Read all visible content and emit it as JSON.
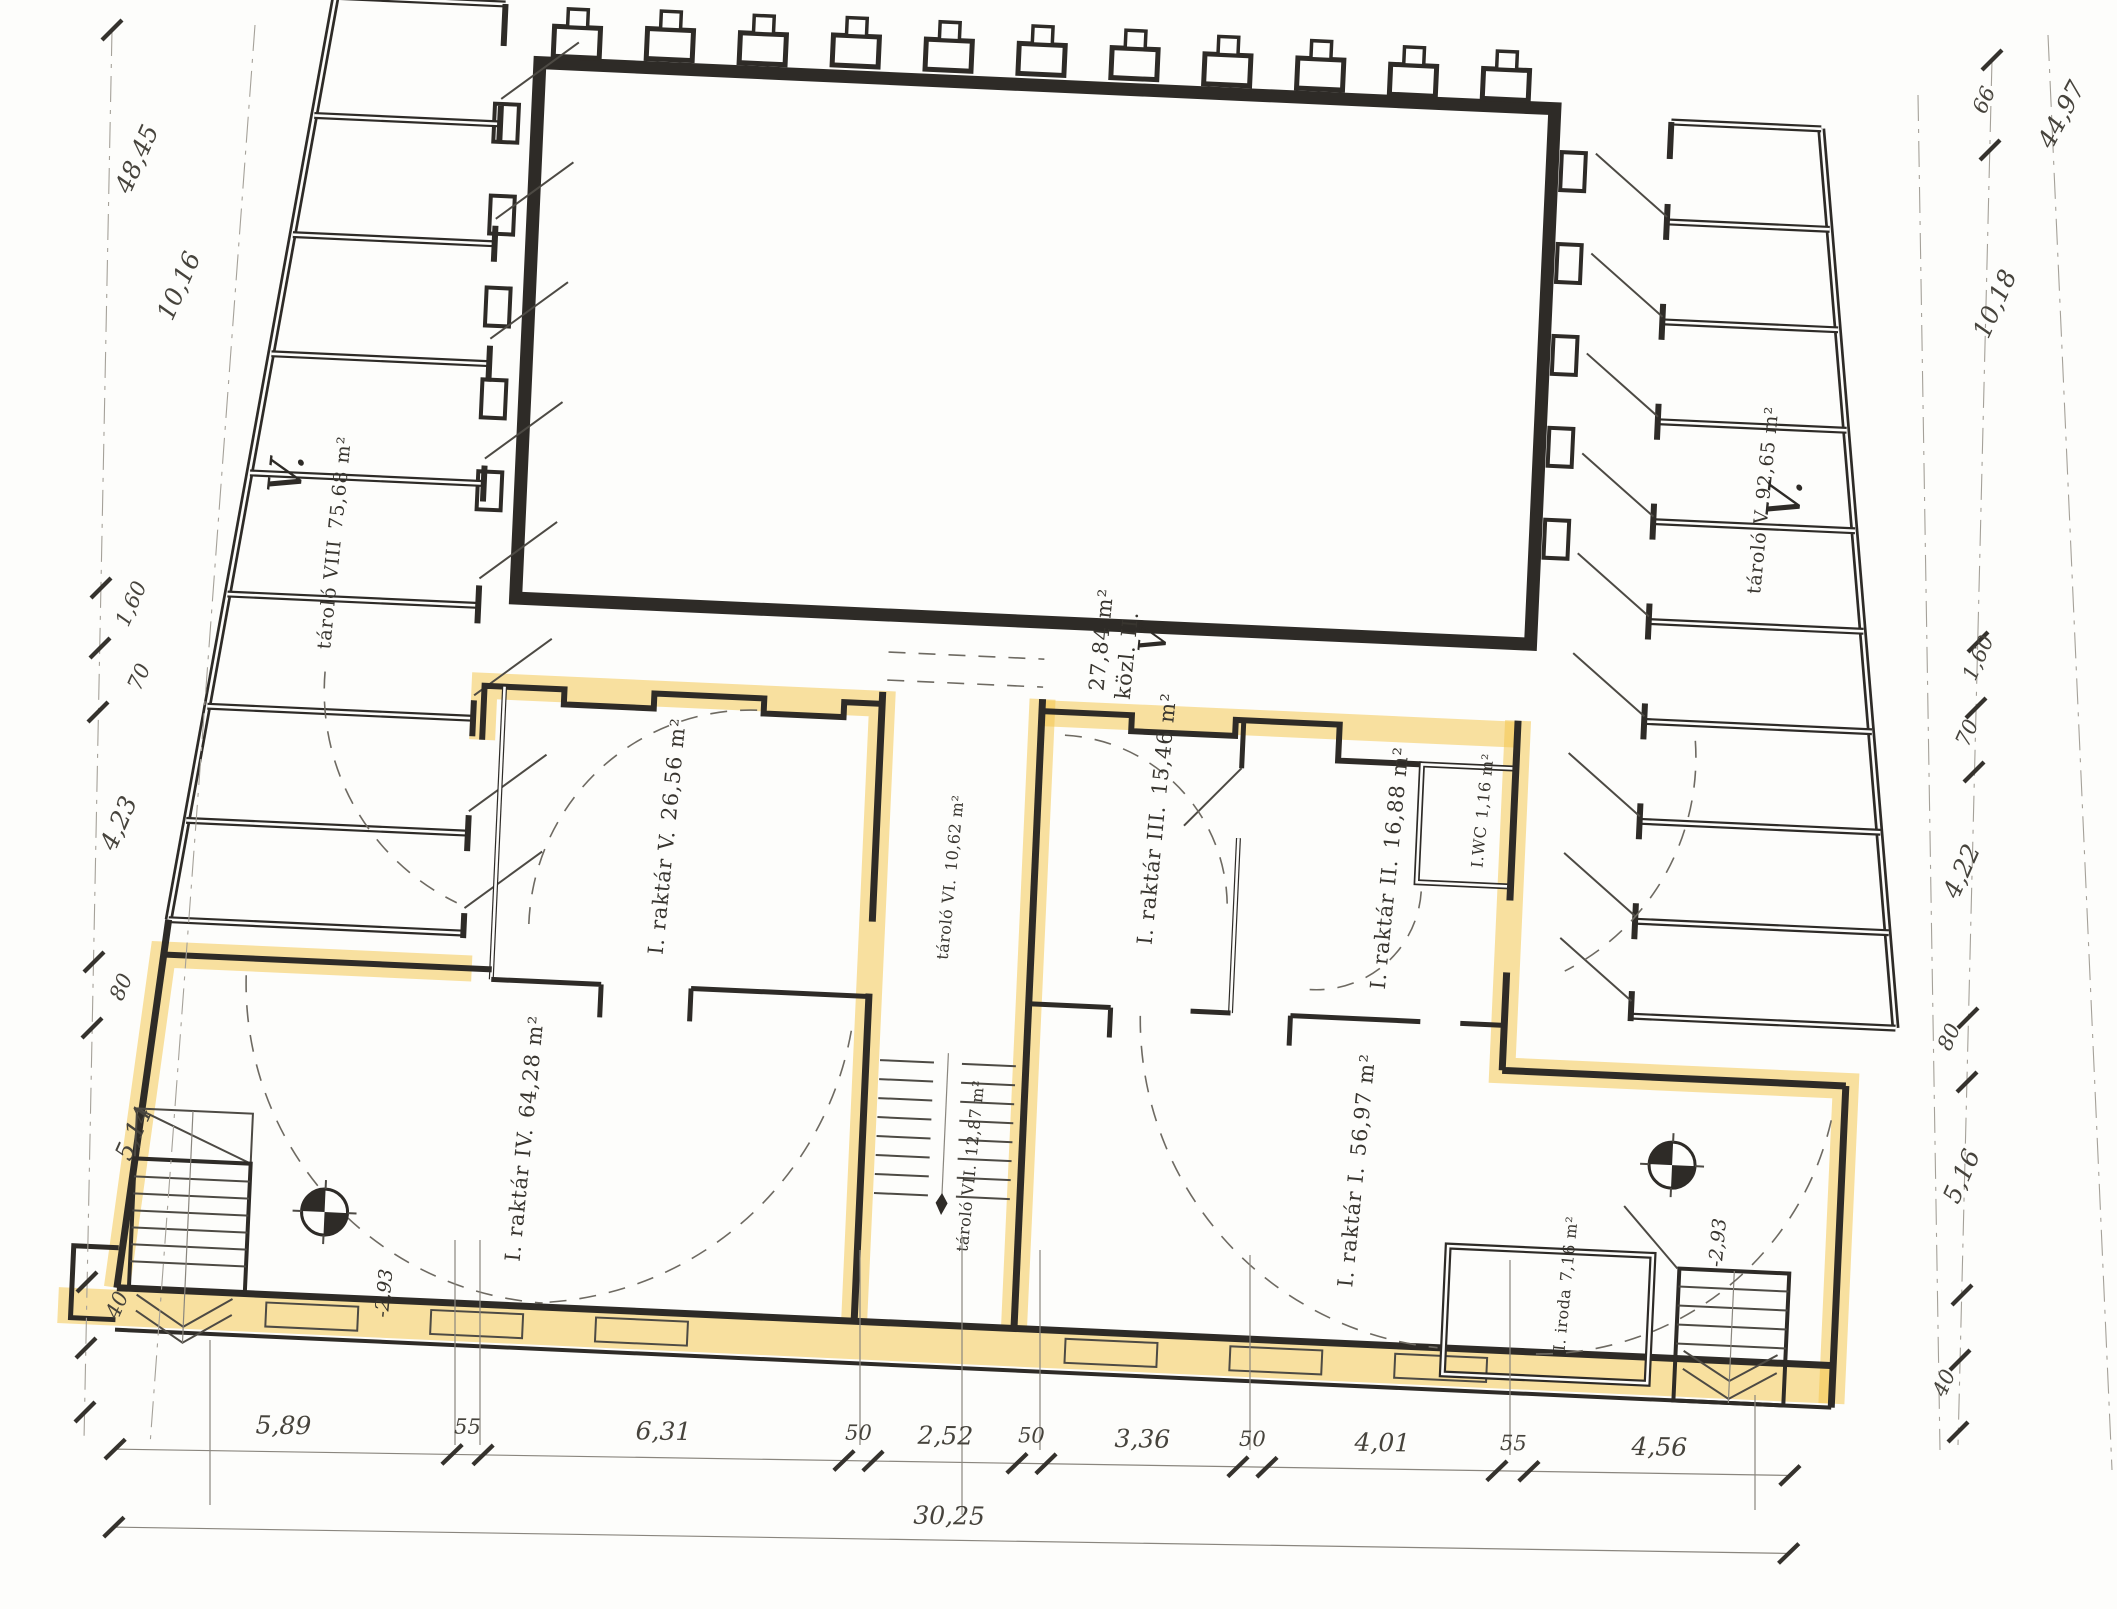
{
  "floor_level_mark": "V.",
  "rooms": {
    "tarolo_viii": {
      "name": "tároló VIII",
      "area": "75,68 m²"
    },
    "tarolo_v": {
      "name": "tároló V",
      "area": "92,65 m²"
    },
    "kozl_ii": {
      "name": "közl. II.",
      "area": "27,84 m²"
    },
    "raktar_v": {
      "name": "I. raktár V.",
      "area": "26,56 m²"
    },
    "tarolo_vi": {
      "name": "tároló VI.",
      "area": "10,62 m²"
    },
    "raktar_iii": {
      "name": "I. raktár III.",
      "area": "15,46 m²"
    },
    "raktar_ii": {
      "name": "I. raktár II.",
      "area": "16,88 m²"
    },
    "wc": {
      "name": "I.WC",
      "area": "1,16 m²"
    },
    "raktar_iv": {
      "name": "I. raktár IV.",
      "area": "64,28 m²"
    },
    "tarolo_vii": {
      "name": "tároló VII.",
      "area": "12,87 m²"
    },
    "raktar_i": {
      "name": "I. raktár I.",
      "area": "56,97 m²"
    },
    "iroda": {
      "name": "I. iroda",
      "area": "7,16 m²"
    }
  },
  "level_markers": {
    "left": "-2,93",
    "right": "-2,93"
  },
  "dimensions": {
    "bottom_segments": [
      "5,89",
      "55",
      "6,31",
      "50",
      "2,52",
      "50",
      "3,36",
      "50",
      "4,01",
      "55",
      "4,56"
    ],
    "bottom_total": "30,25",
    "left_side": [
      "48,45",
      "10,16",
      "1,60",
      "70",
      "4,23",
      "80",
      "5,14",
      "40"
    ],
    "right_side": [
      "66",
      "44,97",
      "10,18",
      "1,60",
      "70",
      "4,22",
      "80",
      "5,16",
      "40"
    ]
  },
  "colors": {
    "highlight": "#f3c64a",
    "ink": "#2e2b27",
    "paper": "#fdfdfb"
  }
}
